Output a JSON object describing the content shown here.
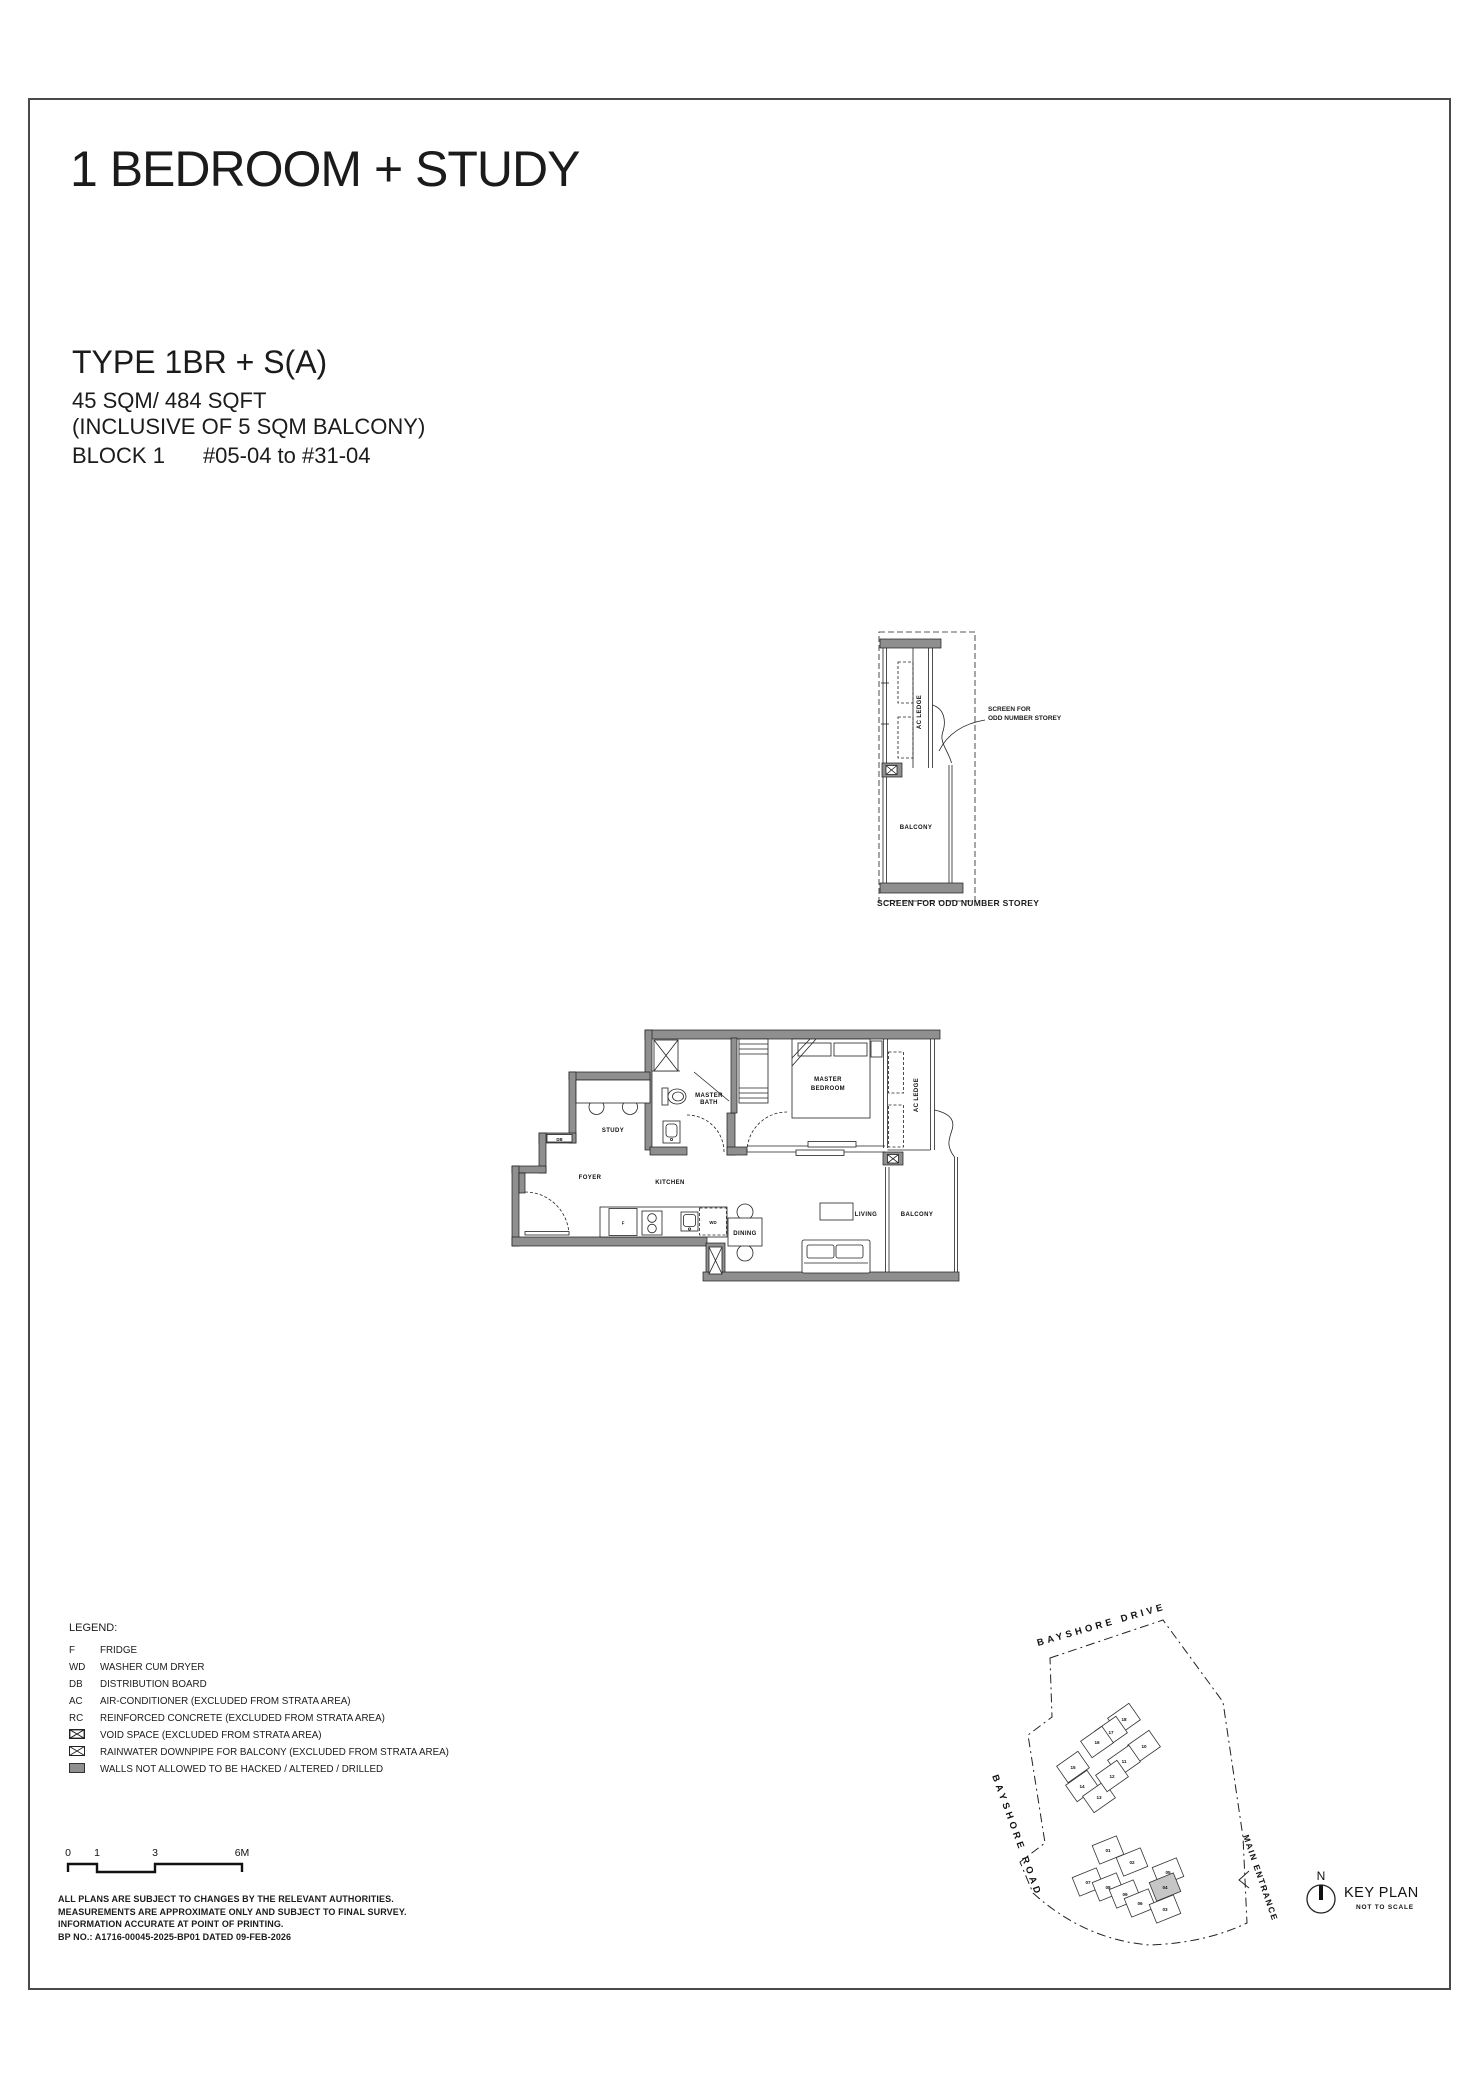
{
  "header": {
    "title": "1 BEDROOM + STUDY"
  },
  "unit_info": {
    "type": "TYPE 1BR + S(A)",
    "area": "45 SQM/ 484 SQFT",
    "area_note": "(INCLUSIVE OF 5 SQM BALCONY)",
    "block": "BLOCK 1",
    "stack": "#05-04 to #31-04"
  },
  "detail_plan": {
    "ac_ledge": "AC LEDGE",
    "balcony": "BALCONY",
    "annotation": [
      "SCREEN FOR",
      "ODD NUMBER STOREY"
    ],
    "caption": "SCREEN FOR ODD NUMBER STOREY"
  },
  "floor_plan": {
    "study": "STUDY",
    "foyer": "FOYER",
    "kitchen": "KITCHEN",
    "dining": "DINING",
    "living": "LIVING",
    "balcony": "BALCONY",
    "master_bath": [
      "MASTER",
      "BATH"
    ],
    "master_bedroom": [
      "MASTER",
      "BEDROOM"
    ],
    "ac_ledge": "AC LEDGE",
    "db": "DB",
    "fridge": "F",
    "washer": "WD"
  },
  "legend": {
    "title": "LEGEND:",
    "items": [
      {
        "key": "F",
        "label": "FRIDGE"
      },
      {
        "key": "WD",
        "label": "WASHER CUM DRYER"
      },
      {
        "key": "DB",
        "label": "DISTRIBUTION BOARD"
      },
      {
        "key": "AC",
        "label": "AIR-CONDITIONER (EXCLUDED FROM STRATA AREA)"
      },
      {
        "key": "RC",
        "label": "REINFORCED CONCRETE (EXCLUDED FROM STRATA AREA)"
      },
      {
        "key": "",
        "icon": "void-space",
        "label": "VOID SPACE (EXCLUDED FROM STRATA AREA)"
      },
      {
        "key": "",
        "icon": "rainwater-downpipe",
        "label": "RAINWATER DOWNPIPE FOR BALCONY (EXCLUDED FROM STRATA AREA)"
      },
      {
        "key": "",
        "icon": "protected-wall",
        "label": "WALLS NOT ALLOWED TO BE HACKED / ALTERED / DRILLED"
      }
    ]
  },
  "scale_bar": {
    "labels": [
      "0",
      "1",
      "3",
      "6M"
    ]
  },
  "disclaimer": {
    "lines": [
      "ALL PLANS ARE SUBJECT TO CHANGES BY THE RELEVANT AUTHORITIES.",
      "MEASUREMENTS ARE APPROXIMATE ONLY AND SUBJECT TO FINAL SURVEY.",
      "INFORMATION ACCURATE AT POINT OF PRINTING.",
      "BP NO.: A1716-00045-2025-BP01 DATED 09-FEB-2026"
    ]
  },
  "key_plan": {
    "road_top": "BAYSHORE DRIVE",
    "road_left": "BAYSHORE ROAD",
    "entrance": "MAIN ENTRANCE",
    "north": "N",
    "title": "KEY PLAN",
    "subtitle": "NOT TO SCALE",
    "highlight_unit": "04",
    "upper_units": [
      "18",
      "17",
      "16",
      "15",
      "14",
      "13",
      "10",
      "11",
      "12"
    ],
    "lower_units": [
      "01",
      "02",
      "05",
      "07",
      "08",
      "09",
      "06",
      "04",
      "03"
    ]
  },
  "colors": {
    "wall": "#8f8f8f",
    "highlight": "#c6c6c6",
    "line": "#1a1a1a"
  }
}
